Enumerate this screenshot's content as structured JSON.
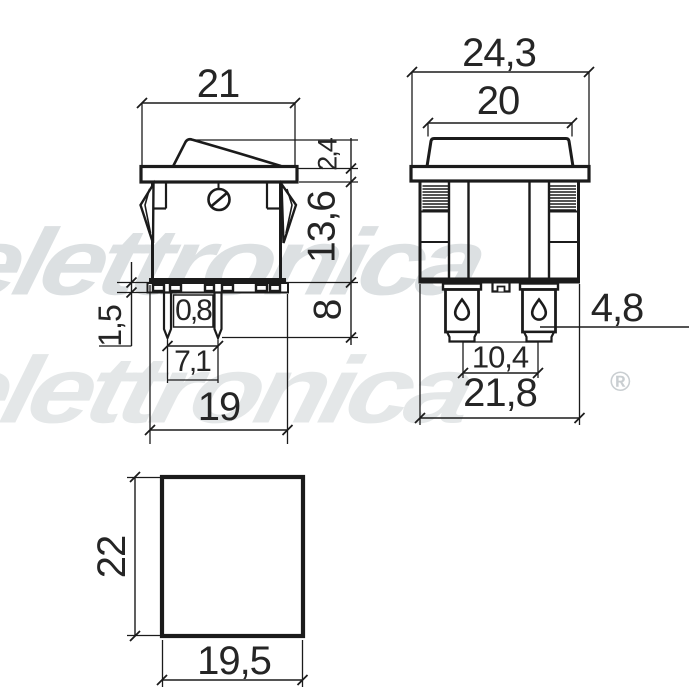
{
  "watermark": {
    "line1": "elettronica",
    "line2": "elettronica",
    "registered": "®"
  },
  "side_view": {
    "dims": {
      "top_width": "21",
      "flange_thickness": "2,4",
      "body_depth": "13,6",
      "pin_length": "8",
      "plate_thickness": "1,5",
      "pin_thickness": "0,8",
      "pin_spacing": "7,1",
      "bottom_width": "19"
    }
  },
  "front_view": {
    "dims": {
      "flange_width": "24,3",
      "rocker_width": "20",
      "terminal_width": "4,8",
      "terminal_spacing": "10,4",
      "body_width": "21,8"
    }
  },
  "panel_cutout": {
    "dims": {
      "height": "22",
      "width": "19,5"
    }
  },
  "colors": {
    "line": "#1b1b1b",
    "text": "#252525",
    "watermark": "#dce0e2",
    "background": "#ffffff"
  }
}
